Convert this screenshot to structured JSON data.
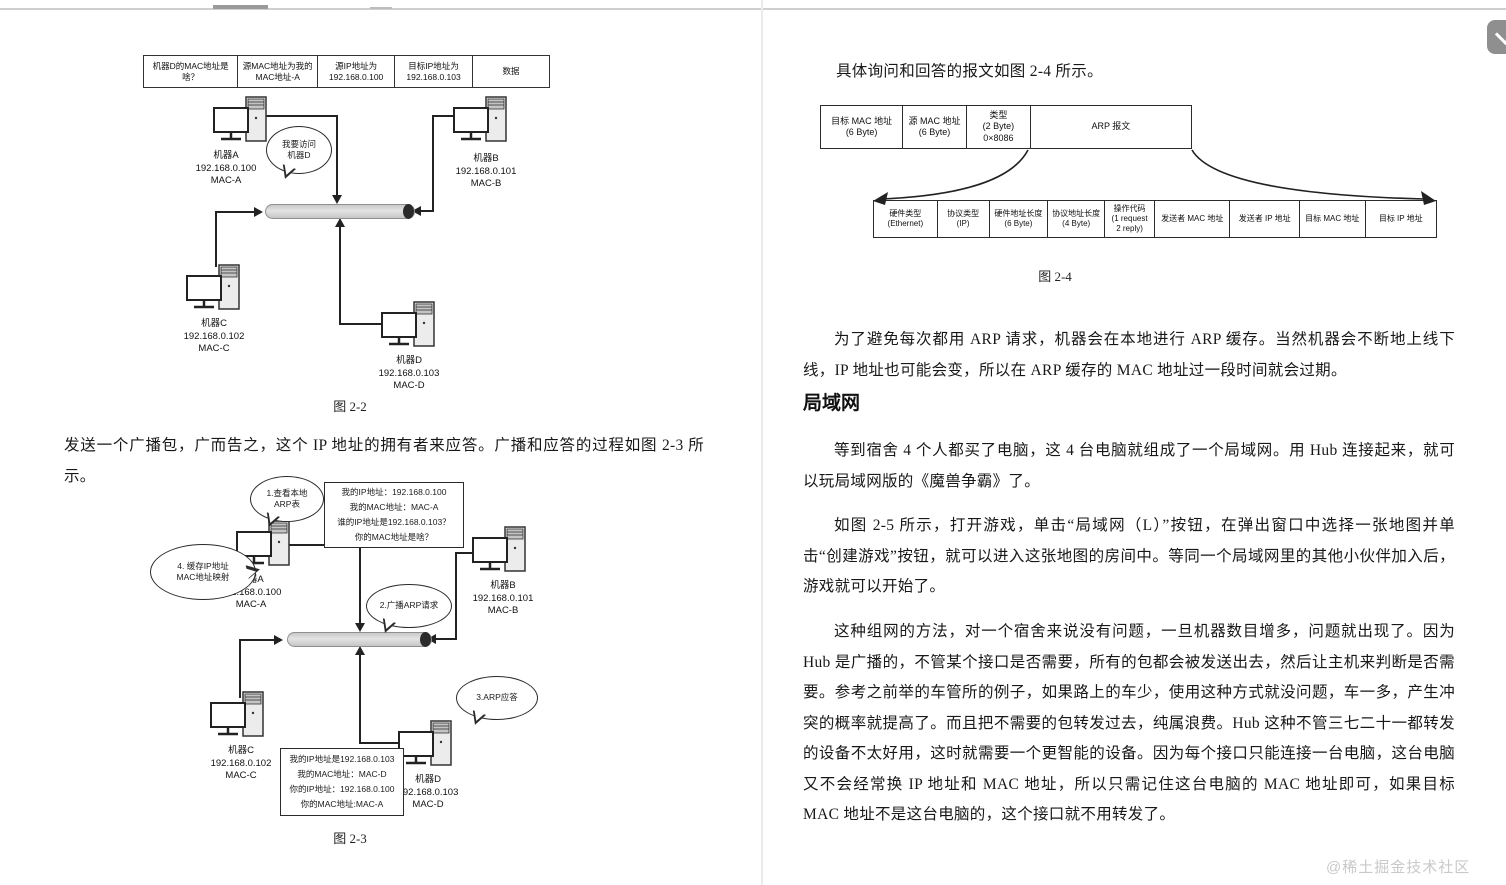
{
  "page": {
    "watermark": "@稀土掘金技术社区",
    "floating_button": {
      "icon": "chevron-down"
    }
  },
  "machines": {
    "a": {
      "name": "机器A",
      "ip": "192.168.0.100",
      "mac": "MAC-A"
    },
    "b": {
      "name": "机器B",
      "ip": "192.168.0.101",
      "mac": "MAC-B"
    },
    "c": {
      "name": "机器C",
      "ip": "192.168.0.102",
      "mac": "MAC-C"
    },
    "d": {
      "name": "机器D",
      "ip": "192.168.0.103",
      "mac": "MAC-D"
    }
  },
  "left_page": {
    "packet_table": [
      "机器D的MAC地址是\n啥？",
      "源MAC地址为我的\nMAC地址-A",
      "源IP地址为\n192.168.0.100",
      "目标IP地址为\n192.168.0.103",
      "数据"
    ],
    "fig22": {
      "caption": "图 2-2",
      "bubble_visit": "我要访问\n机器D"
    },
    "paragraph": "发送一个广播包，广而告之，这个 IP 地址的拥有者来应答。广播和应答的过程如图 2-3 所示。",
    "fig23": {
      "caption": "图 2-3",
      "bubble_step1": "1.查看本地\nARP表",
      "bubble_step2": "2.广播ARP请求",
      "bubble_step3": "3.ARP应答",
      "bubble_step4": "4. 缓存IP地址\nMAC地址映射",
      "request_box": "我的IP地址：192.168.0.100\n我的MAC地址：MAC-A\n谁的IP地址是192.168.0.103？\n你的MAC地址是啥？",
      "reply_box": "我的IP地址是192.168.0.103\n我的MAC地址：MAC-D\n你的IP地址：192.168.0.100\n你的MAC地址:MAC-A"
    }
  },
  "right_page": {
    "para_intro": "具体询问和回答的报文如图 2-4 所示。",
    "fig24": {
      "caption": "图 2-4",
      "frame_row": [
        "目标 MAC 地址\n(6 Byte)",
        "源 MAC 地址\n(6 Byte)",
        "类型\n(2 Byte)\n0×8086",
        "ARP 报文"
      ],
      "arp_row": [
        "硬件类型\n(Ethernet)",
        "协议类型\n(IP)",
        "硬件地址长度\n(6 Byte)",
        "协议地址长度\n(4 Byte)",
        "操作代码\n(1 request\n2 reply)",
        "发送者 MAC 地址",
        "发送者 IP 地址",
        "目标 MAC 地址",
        "目标 IP 地址"
      ]
    },
    "para_arp_cache": "为了避免每次都用 ARP 请求，机器会在本地进行 ARP 缓存。当然机器会不断地上线下线，IP 地址也可能会变，所以在 ARP 缓存的 MAC 地址过一段时间就会过期。",
    "heading_lan": "局域网",
    "para_lan_1": "等到宿舍 4 个人都买了电脑，这 4 台电脑就组成了一个局域网。用 Hub 连接起来，就可以玩局域网版的《魔兽争霸》了。",
    "para_lan_2": "如图 2-5 所示，打开游戏，单击“局域网（L）”按钮，在弹出窗口中选择一张地图并单击“创建游戏”按钮，就可以进入这张地图的房间中。等同一个局域网里的其他小伙伴加入后，游戏就可以开始了。",
    "para_lan_3": "这种组网的方法，对一个宿舍来说没有问题，一旦机器数目增多，问题就出现了。因为 Hub 是广播的，不管某个接口是否需要，所有的包都会被发送出去，然后让主机来判断是否需要。参考之前举的车管所的例子，如果路上的车少，使用这种方式就没问题，车一多，产生冲突的概率就提高了。而且把不需要的包转发过去，纯属浪费。Hub 这种不管三七二十一都转发的设备不太好用，这时就需要一个更智能的设备。因为每个接口只能连接一台电脑，这台电脑又不会经常换 IP 地址和 MAC 地址，所以只需记住这台电脑的 MAC 地址即可，如果目标 MAC 地址不是这台电脑的，这个接口就不用转发了。"
  }
}
